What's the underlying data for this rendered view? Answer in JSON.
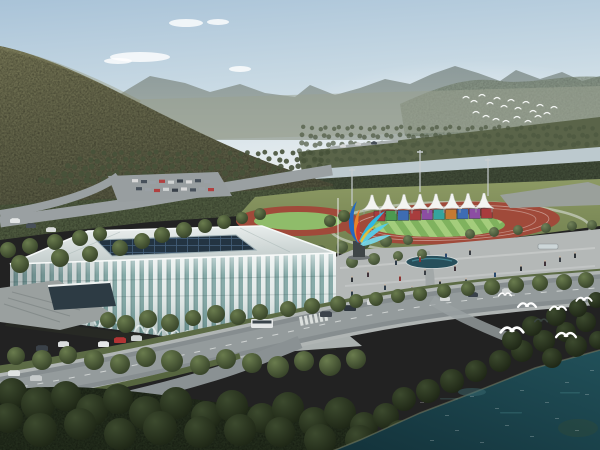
{
  "meta": {
    "subject": "aerial-architectural-rendering-sports-center",
    "elements": [
      "sky",
      "clouds",
      "mountains",
      "forest-hill",
      "river",
      "stadium-arena",
      "athletics-track",
      "grandstand-tents",
      "flame-sculpture",
      "plaza",
      "roads",
      "vehicles",
      "pedestrians",
      "lake",
      "seagulls",
      "bird-flock"
    ]
  },
  "palette": {
    "sky_top": "#a9c3d8",
    "sky_horizon": "#e7edef",
    "mountain_far": "#8f9c9c",
    "mountain_right": "#78866f",
    "hill": "#6e6e50",
    "hill_dark": "#53553f",
    "forest": "#4e5a3f",
    "forest_dark": "#232d1c",
    "river": "#bcc9ce",
    "lawn": "#87945f",
    "track_red": "#a04a3a",
    "field_light": "#a9cf80",
    "field_dark": "#7fb25e",
    "tent_white": "#f3f4f1",
    "stand_colors": [
      "#a83d3d",
      "#4c9950",
      "#3e6cb3",
      "#a83d3d",
      "#8c4ea3",
      "#35a49e",
      "#c57a33",
      "#3e6cb3",
      "#8c4ea3",
      "#a83d3d"
    ],
    "stadium_fin": "#e7edec",
    "stadium_glass": "#86aaa8",
    "stadium_roof": "#dfe6e5",
    "skylight": "#233442",
    "plaza": "#b4b8b7",
    "road": "#868d8f",
    "pond": "#274f5b",
    "water_deep": "#13323a",
    "water_light": "#215059",
    "sculpture_colors": [
      "#2468c0",
      "#2fb9e2",
      "#55cdea",
      "#7addf0",
      "#e8832c",
      "#cf3b2f",
      "#f0c030"
    ],
    "bird": "#ffffff"
  },
  "clouds": [
    [
      140,
      57,
      30,
      5
    ],
    [
      186,
      23,
      17,
      4
    ],
    [
      218,
      22,
      11,
      3
    ],
    [
      240,
      69,
      11,
      3
    ],
    [
      118,
      61,
      14,
      3
    ]
  ],
  "orchard_rows": [
    {
      "y": 153,
      "x0": 95,
      "x1": 330,
      "step": 9,
      "r": 2.4
    },
    {
      "y": 160,
      "x0": 80,
      "x1": 330,
      "step": 9,
      "r": 2.6
    },
    {
      "y": 167,
      "x0": 66,
      "x1": 332,
      "step": 9,
      "r": 2.8
    },
    {
      "y": 174,
      "x0": 54,
      "x1": 300,
      "step": 9,
      "r": 3.0
    },
    {
      "y": 181,
      "x0": 40,
      "x1": 262,
      "step": 9,
      "r": 3.2
    }
  ],
  "farshore_rows": [
    {
      "y": 128,
      "x0": 305,
      "x1": 598,
      "step": 7,
      "r": 2.2
    },
    {
      "y": 136,
      "x0": 302,
      "x1": 598,
      "step": 7,
      "r": 2.4
    },
    {
      "y": 144,
      "x0": 300,
      "x1": 598,
      "step": 7,
      "r": 2.6
    },
    {
      "y": 152,
      "x0": 300,
      "x1": 598,
      "step": 7,
      "r": 2.6
    },
    {
      "y": 160,
      "x0": 300,
      "x1": 420,
      "step": 7,
      "r": 2.4
    }
  ],
  "tents": {
    "count": 8,
    "x0": 372,
    "step": 16,
    "peak_y": 195,
    "base_y": 210,
    "half_width": 10
  },
  "stands": {
    "x0": 374,
    "step": 11.9,
    "w": 11,
    "h": 10,
    "y": 211,
    "colors": [
      "#a83d3d",
      "#4c9950",
      "#3e6cb3",
      "#a83d3d",
      "#8c4ea3",
      "#35a49e",
      "#c57a33",
      "#3e6cb3",
      "#8c4ea3",
      "#a83d3d"
    ]
  },
  "field_stripes": {
    "count": 14,
    "light": "#a9cf80",
    "dark": "#7fb25e"
  },
  "trees": {
    "mid": [
      [
        108,
        320,
        8
      ],
      [
        126,
        324,
        9
      ],
      [
        148,
        319,
        9
      ],
      [
        170,
        323,
        9
      ],
      [
        193,
        318,
        8
      ],
      [
        216,
        314,
        9
      ],
      [
        238,
        317,
        8
      ],
      [
        260,
        312,
        8
      ],
      [
        288,
        309,
        8
      ],
      [
        312,
        306,
        8
      ],
      [
        338,
        304,
        8
      ],
      [
        356,
        301,
        7
      ],
      [
        376,
        299,
        7
      ],
      [
        398,
        296,
        7
      ],
      [
        420,
        294,
        7
      ],
      [
        444,
        291,
        7
      ],
      [
        468,
        289,
        7
      ],
      [
        492,
        287,
        8
      ],
      [
        516,
        285,
        8
      ],
      [
        540,
        283,
        8
      ],
      [
        564,
        282,
        8
      ],
      [
        586,
        280,
        8
      ],
      [
        16,
        356,
        9
      ],
      [
        42,
        360,
        10
      ],
      [
        68,
        355,
        9
      ],
      [
        94,
        360,
        10
      ],
      [
        120,
        364,
        10
      ],
      [
        146,
        357,
        10
      ],
      [
        172,
        361,
        11
      ],
      [
        200,
        365,
        10
      ],
      [
        226,
        359,
        10
      ],
      [
        252,
        363,
        10
      ],
      [
        278,
        367,
        11
      ],
      [
        304,
        361,
        10
      ],
      [
        330,
        365,
        11
      ],
      [
        356,
        359,
        10
      ],
      [
        8,
        250,
        8
      ],
      [
        30,
        246,
        8
      ],
      [
        55,
        242,
        8
      ],
      [
        80,
        238,
        8
      ],
      [
        100,
        234,
        7
      ],
      [
        60,
        258,
        9
      ],
      [
        20,
        264,
        9
      ],
      [
        90,
        254,
        8
      ],
      [
        120,
        248,
        8
      ],
      [
        142,
        241,
        8
      ],
      [
        162,
        235,
        8
      ],
      [
        184,
        230,
        8
      ],
      [
        205,
        226,
        7
      ],
      [
        224,
        222,
        7
      ],
      [
        242,
        218,
        6
      ],
      [
        260,
        214,
        6
      ],
      [
        344,
        216,
        6
      ],
      [
        330,
        221,
        6
      ]
    ],
    "dark": [
      [
        12,
        393,
        15
      ],
      [
        38,
        404,
        17
      ],
      [
        66,
        396,
        15
      ],
      [
        92,
        410,
        16
      ],
      [
        118,
        399,
        15
      ],
      [
        146,
        413,
        17
      ],
      [
        176,
        403,
        16
      ],
      [
        206,
        416,
        15
      ],
      [
        232,
        406,
        16
      ],
      [
        262,
        418,
        15
      ],
      [
        288,
        408,
        16
      ],
      [
        314,
        422,
        15
      ],
      [
        340,
        413,
        16
      ],
      [
        364,
        426,
        14
      ],
      [
        386,
        416,
        13
      ],
      [
        404,
        399,
        12
      ],
      [
        428,
        391,
        12
      ],
      [
        452,
        381,
        12
      ],
      [
        476,
        371,
        11
      ],
      [
        400,
        434,
        14
      ],
      [
        360,
        440,
        15
      ],
      [
        320,
        440,
        16
      ],
      [
        280,
        432,
        15
      ],
      [
        240,
        430,
        16
      ],
      [
        200,
        432,
        16
      ],
      [
        160,
        428,
        17
      ],
      [
        120,
        434,
        16
      ],
      [
        80,
        424,
        16
      ],
      [
        40,
        430,
        17
      ],
      [
        8,
        418,
        15
      ],
      [
        500,
        361,
        11
      ],
      [
        522,
        351,
        11
      ],
      [
        544,
        341,
        11
      ],
      [
        566,
        332,
        10
      ],
      [
        586,
        322,
        10
      ],
      [
        598,
        340,
        9
      ],
      [
        576,
        346,
        11
      ],
      [
        552,
        358,
        10
      ],
      [
        512,
        340,
        10
      ],
      [
        532,
        326,
        10
      ],
      [
        556,
        316,
        10
      ],
      [
        578,
        308,
        9
      ],
      [
        596,
        300,
        8
      ]
    ],
    "light": [
      [
        342,
        247,
        6
      ],
      [
        364,
        243,
        6
      ],
      [
        386,
        241,
        6
      ],
      [
        300,
        256,
        7
      ],
      [
        320,
        252,
        7
      ],
      [
        408,
        240,
        5
      ],
      [
        470,
        234,
        5
      ],
      [
        494,
        232,
        5
      ],
      [
        518,
        230,
        5
      ],
      [
        546,
        228,
        5
      ],
      [
        572,
        226,
        5
      ],
      [
        592,
        225,
        5
      ],
      [
        352,
        262,
        6
      ],
      [
        374,
        259,
        6
      ],
      [
        398,
        256,
        5
      ],
      [
        422,
        254,
        5
      ]
    ]
  },
  "cars": [
    [
      10,
      219,
      10,
      4,
      "#e2e5e5"
    ],
    [
      26,
      224,
      10,
      4,
      "#474f58"
    ],
    [
      46,
      228,
      10,
      4,
      "#d9dcdc"
    ],
    [
      98,
      342,
      11,
      5,
      "#e6e8e8"
    ],
    [
      114,
      338,
      12,
      5,
      "#b23434"
    ],
    [
      131,
      336,
      11,
      5,
      "#cdd1d1"
    ],
    [
      36,
      346,
      12,
      5,
      "#3a4148"
    ],
    [
      58,
      342,
      11,
      5,
      "#dadddd"
    ],
    [
      8,
      371,
      12,
      5,
      "#dfe2e2"
    ],
    [
      30,
      376,
      12,
      5,
      "#c6caca"
    ],
    [
      320,
      312,
      12,
      5,
      "#3c434b"
    ],
    [
      344,
      306,
      12,
      5,
      "#2f373f"
    ],
    [
      367,
      300,
      12,
      5,
      "#d7dada"
    ],
    [
      440,
      297,
      10,
      4,
      "#d5d8d8"
    ],
    [
      468,
      293,
      10,
      4,
      "#39414a"
    ],
    [
      502,
      289,
      10,
      4,
      "#cfd3d3"
    ],
    [
      535,
      286,
      9,
      4,
      "#dfe1e1"
    ],
    [
      340,
      145,
      6,
      2.5,
      "#d8dada"
    ],
    [
      355,
      143,
      6,
      2.5,
      "#cfd2d2"
    ],
    [
      371,
      142,
      6,
      2.5,
      "#474f57"
    ]
  ],
  "parking_rows": [
    {
      "x0": 132,
      "y": 180,
      "n": 9,
      "step": 9,
      "w": 6,
      "h": 3.2
    },
    {
      "x0": 136,
      "y": 188,
      "n": 9,
      "step": 9,
      "w": 6,
      "h": 3.2
    },
    {
      "x0": 505,
      "y": 186,
      "n": 8,
      "step": 10,
      "w": 7,
      "h": 3
    },
    {
      "x0": 500,
      "y": 194,
      "n": 8,
      "step": 10.5,
      "w": 7,
      "h": 3
    }
  ],
  "parking_colors": [
    "#d8d8d8",
    "#47505a",
    "#9aa0a5",
    "#b04040",
    "#cfd3d3",
    "#39414a"
  ],
  "bus": {
    "x": 251,
    "y": 319,
    "w": 22,
    "h": 9
  },
  "people": [
    [
      352,
      282
    ],
    [
      368,
      277
    ],
    [
      385,
      290
    ],
    [
      400,
      281
    ],
    [
      412,
      292
    ],
    [
      425,
      275
    ],
    [
      440,
      286
    ],
    [
      455,
      271
    ],
    [
      466,
      284
    ],
    [
      480,
      291
    ],
    [
      495,
      277
    ],
    [
      508,
      288
    ],
    [
      521,
      271
    ],
    [
      536,
      282
    ],
    [
      396,
      265
    ],
    [
      420,
      262
    ],
    [
      446,
      258
    ],
    [
      470,
      255
    ],
    [
      300,
      296
    ],
    [
      316,
      300
    ],
    [
      332,
      291
    ],
    [
      282,
      301
    ],
    [
      264,
      306
    ],
    [
      560,
      262
    ],
    [
      575,
      258
    ],
    [
      545,
      266
    ],
    [
      352,
      296
    ],
    [
      372,
      300
    ]
  ],
  "people_colors": [
    "#2e3338",
    "#40333a",
    "#2f3d4a",
    "#8a3434",
    "#2a4a6e",
    "#3a3f45"
  ],
  "gulls": [
    [
      527,
      306,
      1.0,
      0
    ],
    [
      558,
      309,
      0.9,
      0
    ],
    [
      584,
      300,
      0.85,
      0
    ],
    [
      512,
      331,
      1.25,
      0
    ],
    [
      566,
      336,
      1.1,
      0
    ],
    [
      541,
      321,
      0.7,
      1
    ],
    [
      505,
      295,
      0.7,
      0
    ]
  ],
  "flock": [
    [
      466,
      97
    ],
    [
      474,
      101
    ],
    [
      482,
      95
    ],
    [
      490,
      103
    ],
    [
      497,
      98
    ],
    [
      504,
      106
    ],
    [
      511,
      100
    ],
    [
      518,
      108
    ],
    [
      526,
      102
    ],
    [
      533,
      111
    ],
    [
      540,
      105
    ],
    [
      547,
      113
    ],
    [
      554,
      107
    ],
    [
      476,
      112
    ],
    [
      486,
      116
    ],
    [
      496,
      119
    ],
    [
      506,
      121
    ],
    [
      517,
      117
    ],
    [
      528,
      121
    ],
    [
      538,
      116
    ]
  ],
  "sparkles": [
    [
      420,
      402
    ],
    [
      445,
      415
    ],
    [
      470,
      396
    ],
    [
      495,
      408
    ],
    [
      520,
      390
    ],
    [
      545,
      402
    ],
    [
      565,
      382
    ],
    [
      585,
      394
    ],
    [
      455,
      430
    ],
    [
      505,
      425
    ],
    [
      555,
      418
    ],
    [
      590,
      370
    ],
    [
      430,
      440
    ],
    [
      480,
      442
    ],
    [
      530,
      436
    ],
    [
      575,
      430
    ]
  ],
  "streaks": [
    [
      440,
      398,
      18
    ],
    [
      500,
      412,
      22
    ],
    [
      560,
      392,
      20
    ]
  ],
  "arcade": {
    "x0": 14,
    "x1": 328,
    "step": 12
  },
  "masts": [
    [
      352,
      168,
      206
    ],
    [
      420,
      150,
      192
    ],
    [
      488,
      158,
      196
    ]
  ],
  "flagpole": [
    338,
    198,
    256
  ],
  "crosswalk": {
    "x": 299,
    "y": 317,
    "n": 6
  }
}
